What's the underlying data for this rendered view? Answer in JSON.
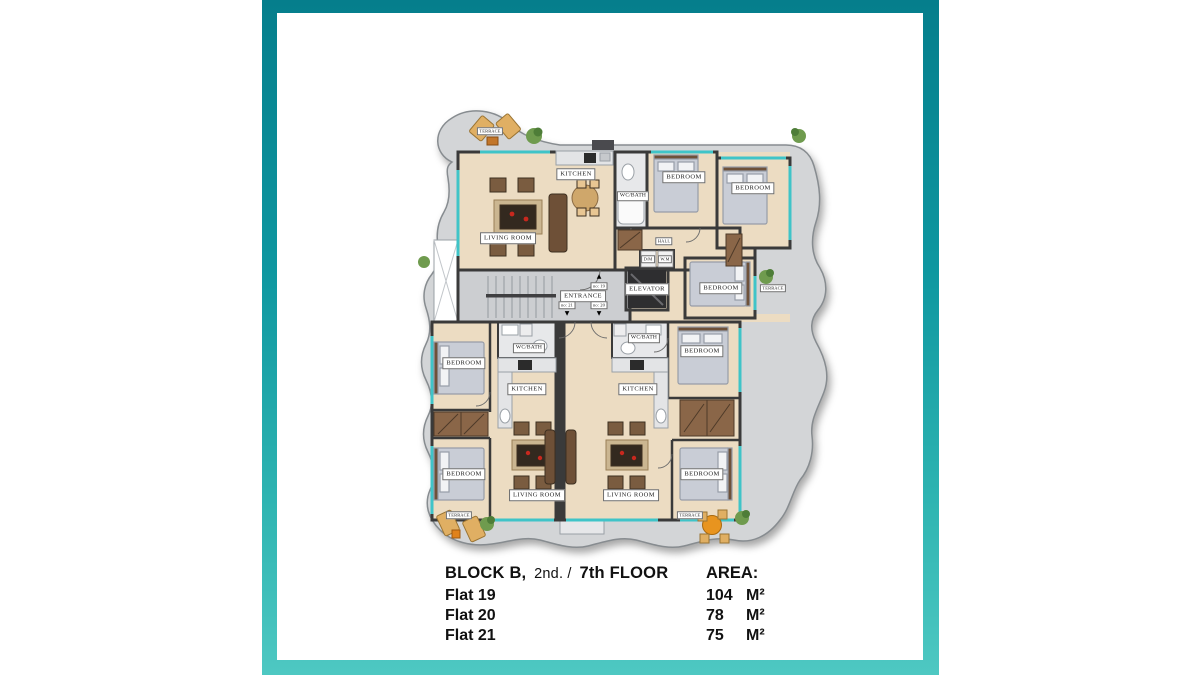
{
  "colors": {
    "frame_top": "#057e8c",
    "frame_bottom": "#4ec8c2",
    "floor": "#ecdcc2",
    "wall": "#3a3a3a",
    "terrace": "#d3d5d7",
    "window": "#3fc4c8",
    "wood": "#7a5c40",
    "wood_dark": "#33291f",
    "bed": "#c9cdd6",
    "accent_orange": "#e8941f",
    "accent_red": "#c8281e",
    "plant": "#6f9b4e",
    "tile": "#e7e8ea",
    "core_floor": "#ccced1",
    "text": "#111111"
  },
  "icons": {
    "direction_up_arrow": "▲",
    "direction_down_arrow": "▼"
  },
  "plan": {
    "labels": {
      "terrace_tl": "TERRACE",
      "kitchen_tl": "KITCHEN",
      "wc_bath_tl": "WC/BATH",
      "bedroom_t1": "BEDROOM",
      "bedroom_t2": "BEDROOM",
      "hall": "HALL",
      "living_room_tl": "LIVING ROOM",
      "dm": "D/M",
      "wm": "W.M",
      "elevator": "ELEVATOR",
      "entrance": "ENTRANCE",
      "no19": "no: 19",
      "no21": "no: 21",
      "no20": "no: 20",
      "bedroom_r": "BEDROOM",
      "terrace_r": "TERRACE",
      "bedroom_ml": "BEDROOM",
      "wc_bath_l": "WC/BATH",
      "kitchen_l": "KITCHEN",
      "bedroom_bl": "BEDROOM",
      "living_room_l": "LIVING ROOM",
      "terrace_bl": "TERRACE",
      "wc_bath_r": "WC/BATH",
      "kitchen_r": "KITCHEN",
      "bedroom_mr": "BEDROOM",
      "bedroom_br": "BEDROOM",
      "living_room_r": "LIVING ROOM",
      "terrace_br": "TERRACE"
    }
  },
  "legend": {
    "title_1": "BLOCK B,",
    "title_2": "2nd. /",
    "title_3": "7th FLOOR",
    "area_label": "AREA:",
    "flats": [
      {
        "name": "Flat 19",
        "value": "104",
        "unit": "M²"
      },
      {
        "name": "Flat 20",
        "value": "78",
        "unit": "M²"
      },
      {
        "name": "Flat 21",
        "value": "75",
        "unit": "M²"
      }
    ]
  }
}
